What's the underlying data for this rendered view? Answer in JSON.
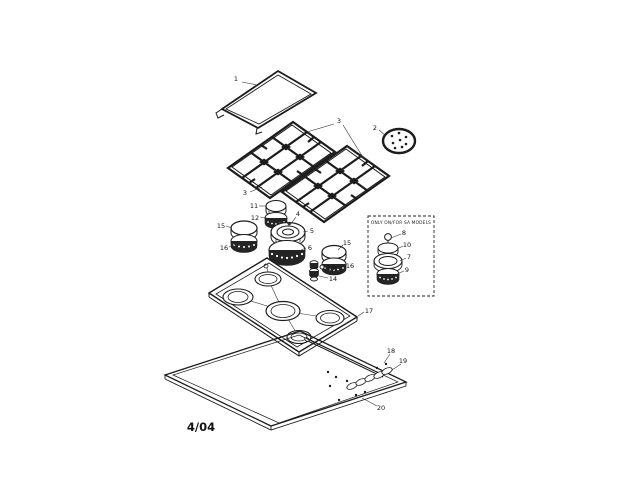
{
  "doc": {
    "date_code": "4/04",
    "colors": {
      "ink": "#1c1c1c",
      "paper": "#ffffff"
    }
  },
  "inset": {
    "caption": "ONLY ON/FOR SA MODELS",
    "callouts": {
      "top_ball": "8",
      "cap": "10",
      "ring": "7",
      "head": "9"
    }
  },
  "callouts": {
    "cover": "1",
    "simmer_plate": "2",
    "grates": "3",
    "center_burner_cap": "4",
    "center_burner_ring": "5",
    "center_burner_head": "6",
    "small_burner_cap": "11",
    "small_burner_head": "12",
    "igniter_washer": "13",
    "igniter": "14",
    "side_burner_cap": "15",
    "side_burner_head": "16",
    "main_top": "17",
    "screw": "18",
    "knob_slot": "19",
    "burner_box": "20"
  }
}
